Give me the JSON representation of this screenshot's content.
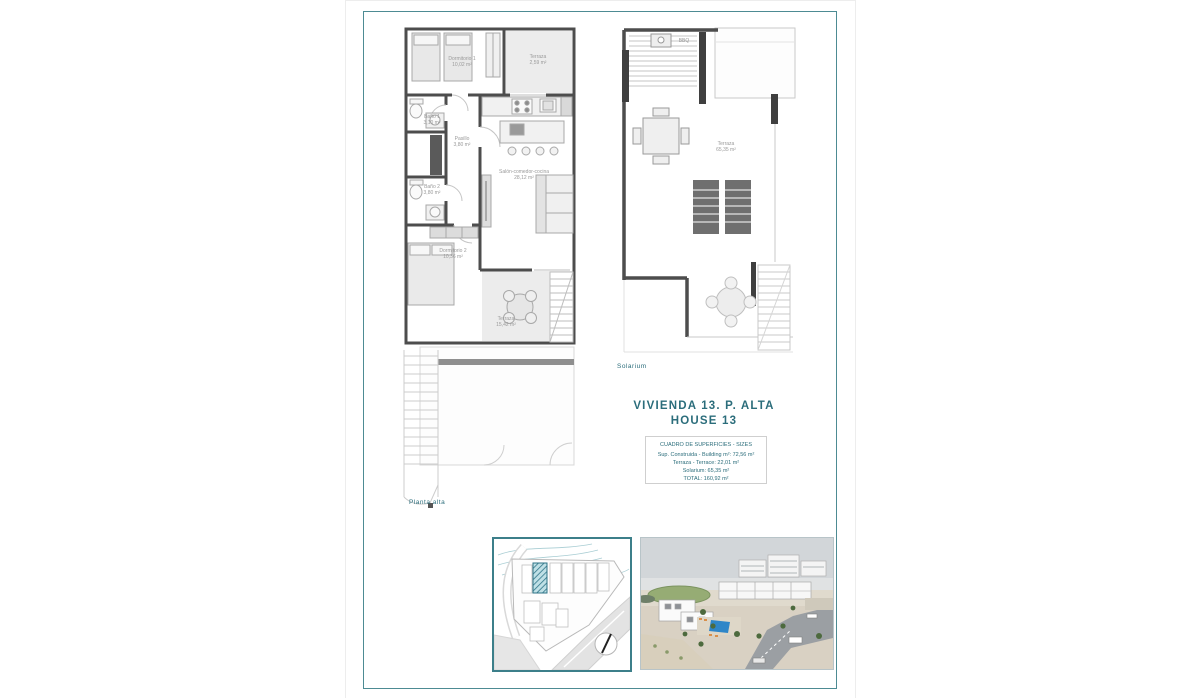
{
  "colors": {
    "accent_teal": "#4d8b93",
    "title_teal": "#2b6d7b",
    "wall_gray": "#4d4d4d",
    "floor_gray": "#ececec",
    "label_gray": "#9a9a9a",
    "pool_blue": "#2f86c8",
    "plot_hatch_teal": "#4e93a3"
  },
  "captions": {
    "upper_floor": "Planta alta",
    "solarium": "Solarium"
  },
  "title_block": {
    "line1": "VIVIENDA 13. P. ALTA",
    "line2": "HOUSE 13"
  },
  "surface_table": {
    "header": "CUADRO DE SUPERFICIES  - SIZES",
    "rows": [
      "Sup. Construida  - Building m²: 72,56 m²",
      "Terraza  - Terrace: 22,01 m²",
      "Solarium: 65,35 m²",
      "TOTAL:  160,92 m²"
    ]
  },
  "upper_plan": {
    "rooms": {
      "dormitorio1": {
        "label": "Dormitorio 1",
        "area": "10,02 m²"
      },
      "terraza_top": {
        "label": "Terraza",
        "area": "2,59 m²"
      },
      "bano1": {
        "label": "Baño 1",
        "area": "3,10 m²"
      },
      "pasillo": {
        "label": "Pasillo",
        "area": "3,80 m²"
      },
      "bano2": {
        "label": "Baño 2",
        "area": "3,80 m²"
      },
      "salon": {
        "label": "Salón-comedor-cocina",
        "area": "28,12 m²"
      },
      "dormitorio2": {
        "label": "Dormitorio 2",
        "area": "10,36 m²"
      },
      "terraza_bottom": {
        "label": "Terraza",
        "area": "15,42 m²"
      }
    }
  },
  "solarium_plan": {
    "terraza": {
      "label": "Terraza",
      "area": "65,35 m²"
    },
    "bbq_label": "BBQ"
  }
}
